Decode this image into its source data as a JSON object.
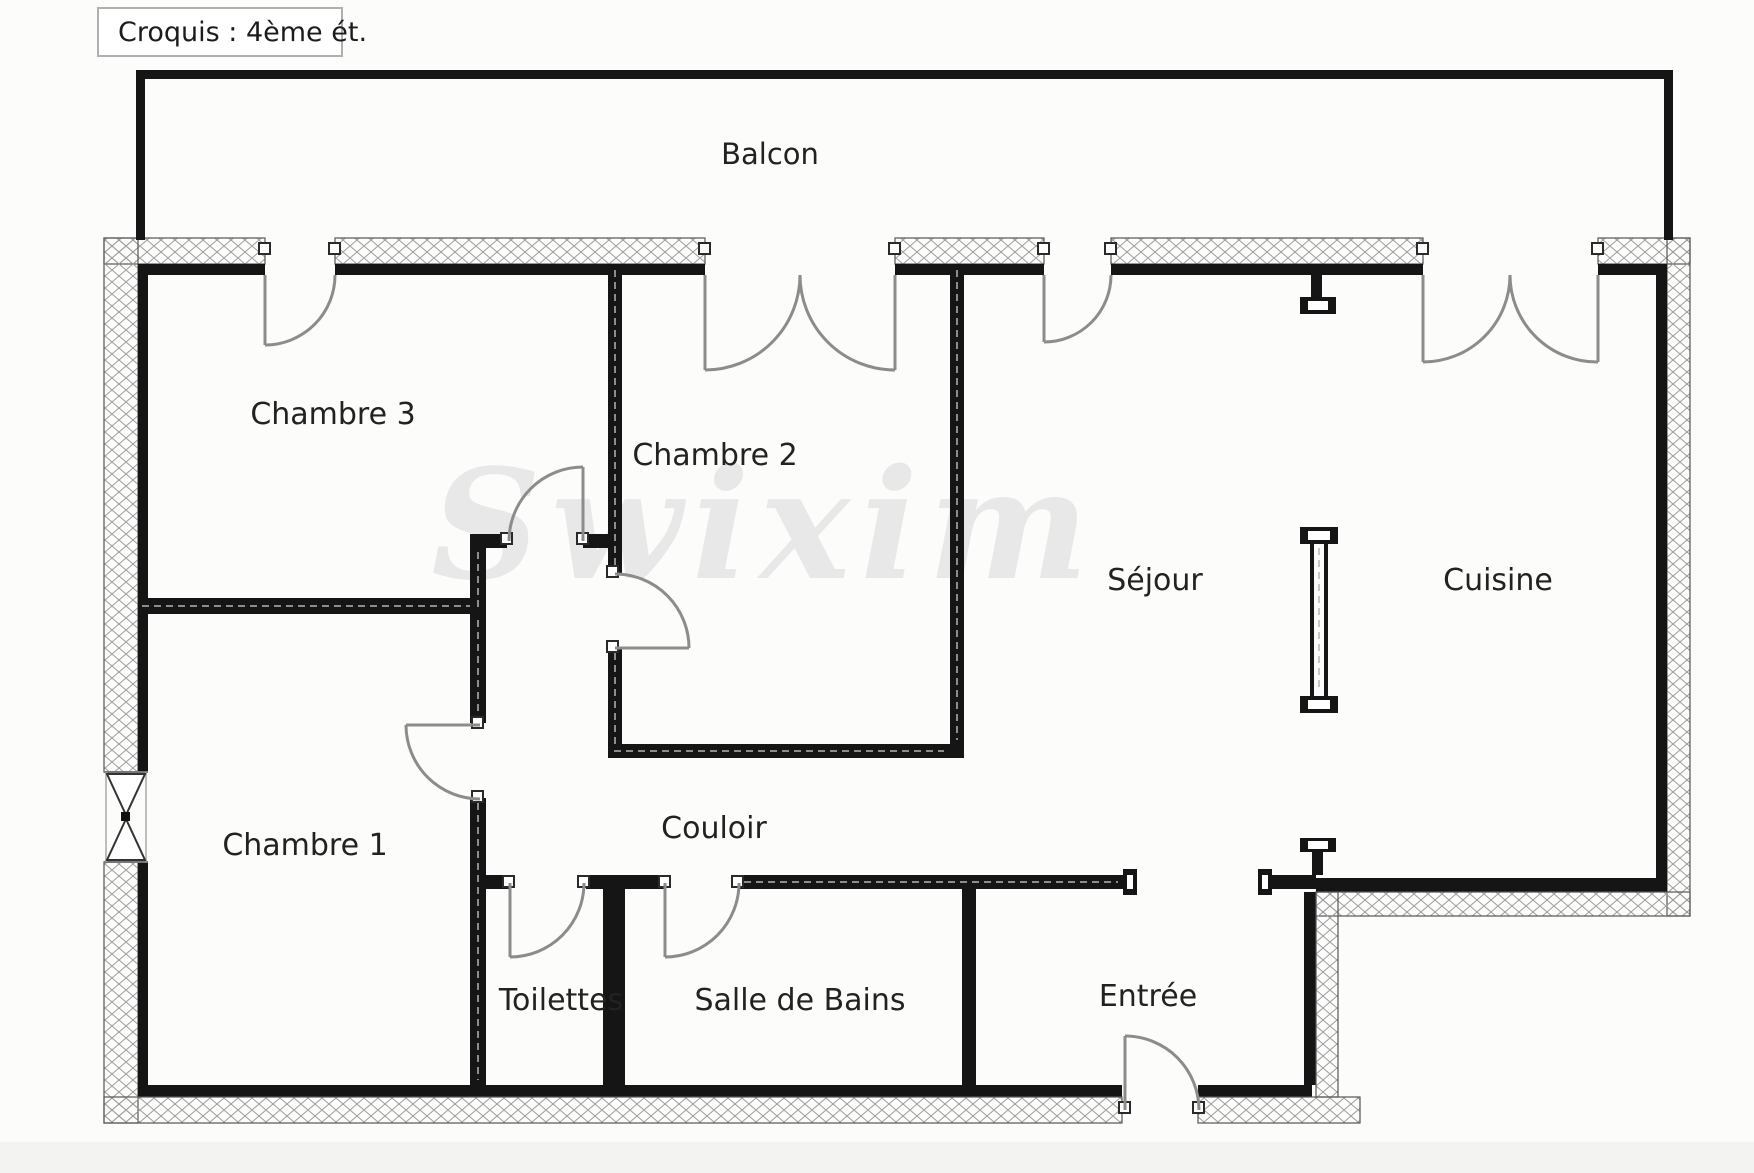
{
  "title": "Croquis : 4ème ét.",
  "watermark": "Swixim",
  "labels": {
    "balcony": "Balcon",
    "bedroom3": "Chambre 3",
    "bedroom2": "Chambre 2",
    "bedroom1": "Chambre 1",
    "living": "Séjour",
    "kitchen": "Cuisine",
    "hallway": "Couloir",
    "toilet": "Toilettes",
    "bathroom": "Salle de Bains",
    "entry": "Entrée"
  },
  "colors": {
    "wall": "#151515",
    "exterior_hatch": "#9b9b9b",
    "door_arc": "#8c8c8c",
    "text": "#222222",
    "watermark": "#e8e8e8",
    "background": "#fcfcfb",
    "title_border": "#b0b0b0"
  }
}
